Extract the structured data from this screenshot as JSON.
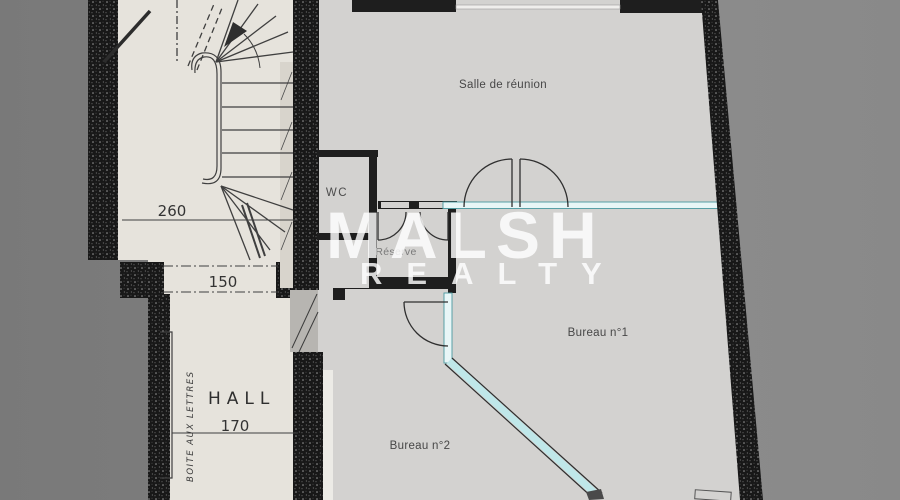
{
  "plan": {
    "watermark": {
      "brand": "MALSH",
      "brand_sub": "REALTY"
    },
    "rooms": {
      "meeting_room": "Salle de réunion",
      "wc": "WC",
      "storage": "Réserve",
      "office1": "Bureau n°1",
      "office2": "Bureau n°2",
      "hall": "HALL"
    },
    "dimensions": {
      "stairwell_width": "260",
      "hall_opening": "150",
      "hall_width": "170"
    },
    "annotations": {
      "mailbox": "BOITE AUX LETTRES"
    },
    "colors": {
      "background": "#828282",
      "scan_paper": "#e6e3dc",
      "cad_paper": "#d3d2d0",
      "wall": "#1b1b1b",
      "glazing": "#bfe7e9",
      "watermark": "#ffffff"
    }
  }
}
